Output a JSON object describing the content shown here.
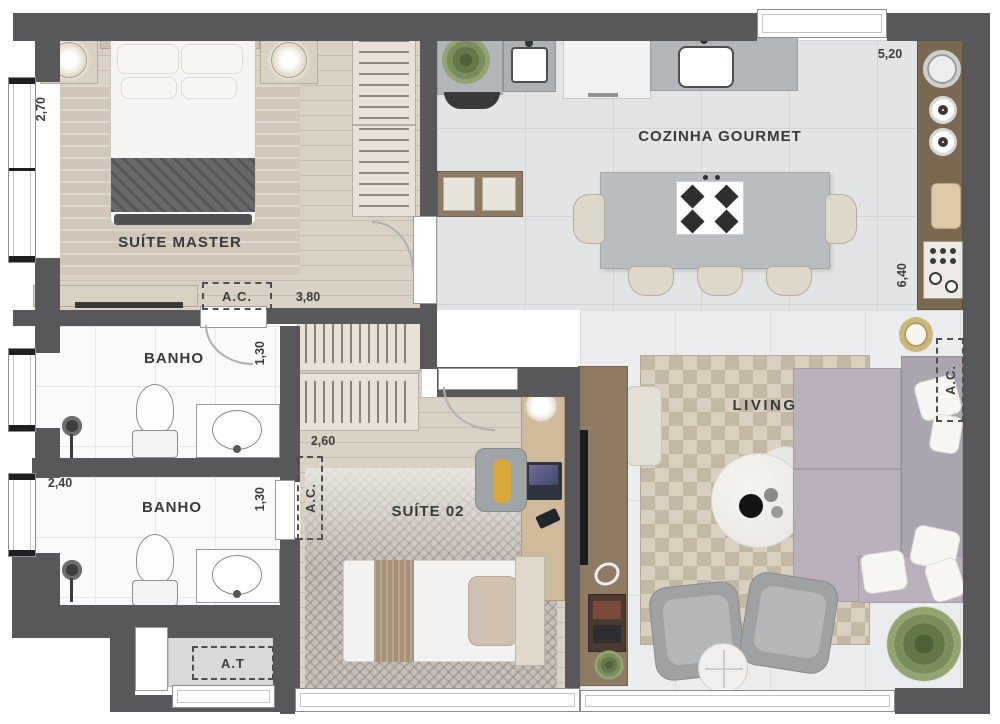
{
  "rooms": {
    "suite_master": "SUÍTE MASTER",
    "cozinha_gourmet": "COZINHA GOURMET",
    "banho_1": "BANHO",
    "banho_2": "BANHO",
    "suite_02": "SUÍTE 02",
    "living": "LIVING"
  },
  "dims": {
    "suite_master_w": "2,70",
    "hall_l": "3,80",
    "kitchen_w": "5,20",
    "kitchen_l": "6,40",
    "banho1_w": "1,30",
    "banho2_l": "2,40",
    "banho2_w": "1,30",
    "closet_w": "2,60"
  },
  "tags": {
    "ac_master": "A.C.",
    "ac_suite02": "A.C.",
    "ac_living": "A.C.",
    "at": "A.T"
  },
  "colors": {
    "wall": "#58585a",
    "wood_floor": "#d9d1c3",
    "kitchen_tile": "#e3e4e6",
    "living_tile": "#ebecee",
    "accent_wood": "#7b6850",
    "sofa": "#b9b0bc",
    "label_text": "#3a3a3a"
  }
}
